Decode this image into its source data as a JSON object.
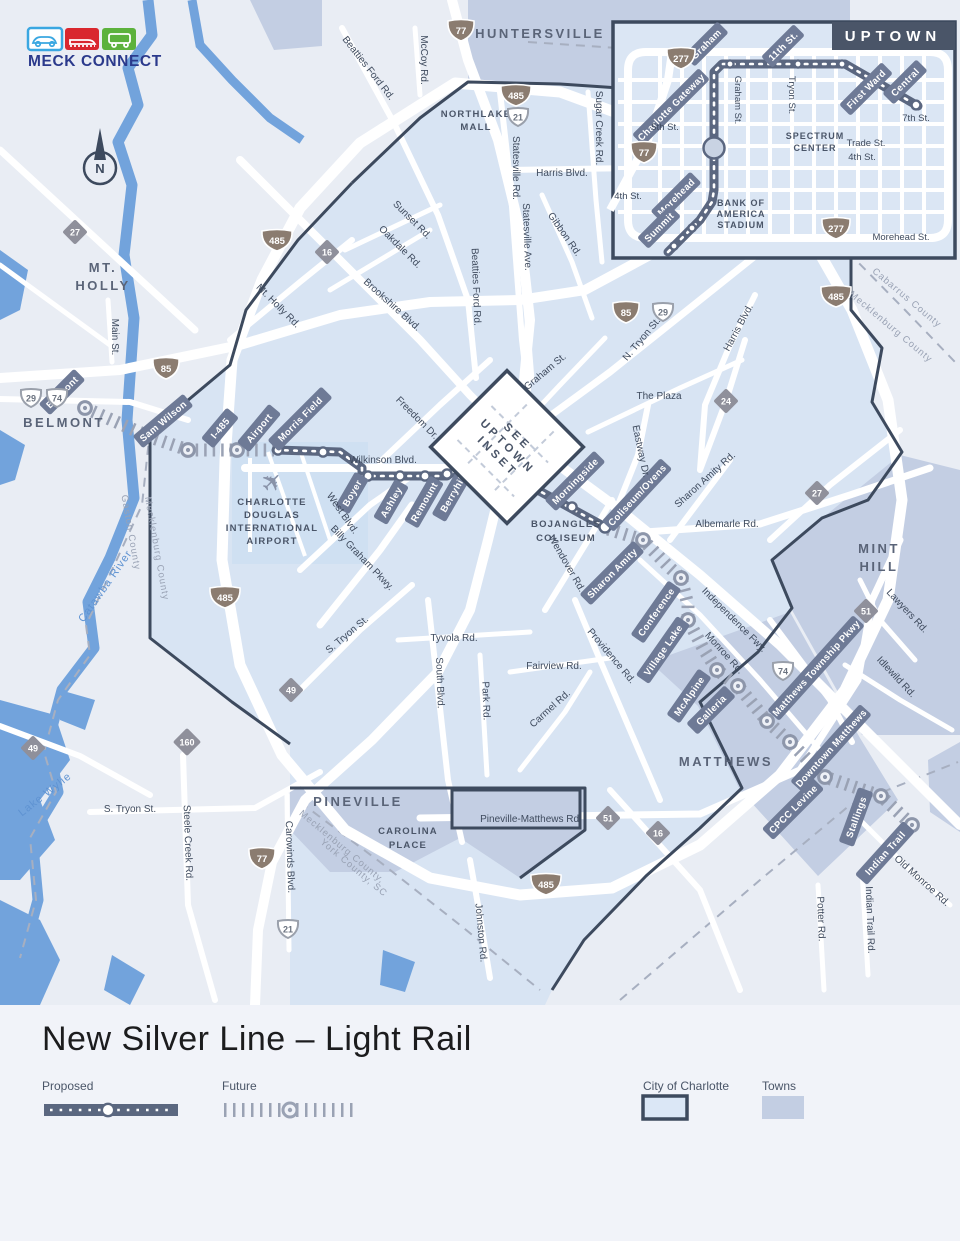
{
  "logo": {
    "name": "MECK CONNECT"
  },
  "compass": {
    "label": "N"
  },
  "legend": {
    "title": "New Silver Line – Light Rail",
    "proposed": "Proposed",
    "future": "Future",
    "city": "City of Charlotte",
    "towns": "Towns"
  },
  "shields": {
    "i77": "77",
    "i85": "85",
    "i277": "277",
    "i485": "485",
    "us21": "21",
    "us29": "29",
    "us74": "74",
    "nc16": "16",
    "nc24": "24",
    "nc27": "27",
    "nc49": "49",
    "nc51": "51",
    "nc160": "160"
  },
  "towns": {
    "huntersville": "HUNTERSVILLE",
    "mtholly": [
      "MT.",
      "HOLLY"
    ],
    "belmont": "BELMONT",
    "minthill": [
      "MINT",
      "HILL"
    ],
    "matthews": "MATTHEWS",
    "pineville": "PINEVILLE"
  },
  "water": [
    "Catawba River",
    "Lake Wylie"
  ],
  "counties": [
    "Cabarrus County",
    "Mecklenburg County",
    "Gaston County",
    "Mecklenburg County",
    "Mecklenburg County,",
    "York County, SC"
  ],
  "pois": {
    "northlake": [
      "NORTHLAKE",
      "MALL"
    ],
    "airport": [
      "CHARLOTTE",
      "DOUGLAS",
      "INTERNATIONAL",
      "AIRPORT"
    ],
    "bojangles": [
      "BOJANGLES",
      "COLISEUM"
    ],
    "carolina": [
      "CAROLINA",
      "PLACE"
    ],
    "inset_note": [
      "SEE",
      "UPTOWN",
      "INSET"
    ]
  },
  "roads": [
    "McCoy Rd.",
    "Beatties Ford Rd.",
    "Sugar Creek Rd.",
    "Harris Blvd.",
    "Statesville Rd.",
    "Sunset Rd.",
    "Oakdale Rd.",
    "Brookshire Blvd.",
    "Beatties Ford Rd.",
    "Statesville Ave.",
    "Gibbon Rd.",
    "Graham St.",
    "N. Tryon St.",
    "Harris Blvd.",
    "The Plaza",
    "Eastway Dr.",
    "Mt. Holly Rd.",
    "Main St.",
    "Freedom Dr.",
    "Wilkinson Blvd.",
    "West Blvd.",
    "Billy Graham Pkwy.",
    "Wendover Rd.",
    "Sharon Amity Rd.",
    "Albemarle Rd.",
    "Independence Fwy.",
    "Monroe Rd.",
    "Providence Rd.",
    "Tyvola Rd.",
    "South Blvd.",
    "Park Rd.",
    "Fairview Rd.",
    "Carmel Rd.",
    "S. Tryon St.",
    "S. Tryon St.",
    "Steele Creek Rd.",
    "Carowinds Blvd.",
    "Johnston Rd.",
    "Pineville-Matthews Rd.",
    "Lawyers Rd.",
    "Idlewild Rd.",
    "Old Monroe Rd.",
    "Indian Trail Rd.",
    "Potter Rd."
  ],
  "stations": [
    "Belmont",
    "Sam Wilson",
    "I-485",
    "Airport",
    "Morris Field",
    "Boyer",
    "Ashley",
    "Remount",
    "Berryhill",
    "Morningside",
    "Coliseum/Ovens",
    "Sharon Amity",
    "Conference",
    "Village Lake",
    "McAlpine",
    "Galleria",
    "Matthews Township Pkwy",
    "Downtown Matthews",
    "CPCC Levine",
    "Stallings",
    "Indian Trail"
  ],
  "inset": {
    "title": "UPTOWN",
    "stations": [
      "Graham",
      "11th St.",
      "First Ward",
      "Central",
      "Charlotte Gateway",
      "Morehead",
      "Summit"
    ],
    "streets": [
      "Graham St.",
      "Tryon St.",
      "5th St.",
      "7th St.",
      "Trade St.",
      "4th St.",
      "4th St.",
      "Morehead St."
    ],
    "pois": {
      "spectrum": [
        "SPECTRUM",
        "CENTER"
      ],
      "stadium": [
        "BANK OF",
        "AMERICA",
        "STADIUM"
      ]
    }
  }
}
